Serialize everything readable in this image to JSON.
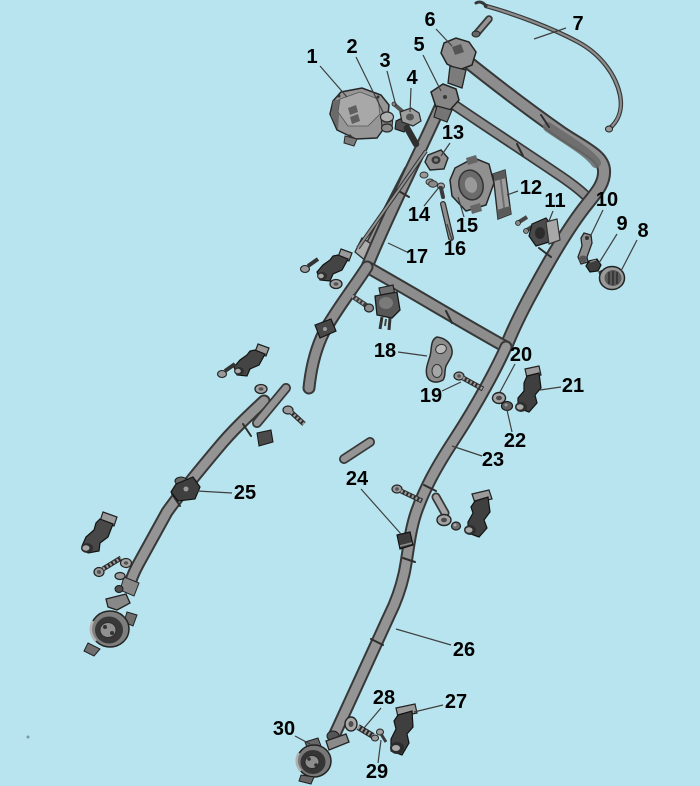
{
  "diagram": {
    "background": "#b7e4ee",
    "label_color": "#000000",
    "leader_color": "#3f3f3f",
    "part_fill": "#8d8d8d",
    "part_outline": "#333333"
  },
  "callouts": [
    {
      "label": "1",
      "x": 312,
      "y": 57,
      "leader": {
        "x1": 320,
        "y1": 66,
        "x2": 347,
        "y2": 97
      }
    },
    {
      "label": "2",
      "x": 352,
      "y": 47,
      "leader": {
        "x1": 356,
        "y1": 57,
        "x2": 384,
        "y2": 114
      }
    },
    {
      "label": "3",
      "x": 385,
      "y": 61,
      "leader": {
        "x1": 387,
        "y1": 71,
        "x2": 396,
        "y2": 106
      }
    },
    {
      "label": "4",
      "x": 412,
      "y": 78,
      "leader": {
        "x1": 411,
        "y1": 88,
        "x2": 410,
        "y2": 112
      }
    },
    {
      "label": "5",
      "x": 419,
      "y": 45,
      "leader": {
        "x1": 423,
        "y1": 55,
        "x2": 441,
        "y2": 91
      }
    },
    {
      "label": "6",
      "x": 430,
      "y": 20,
      "leader": {
        "x1": 436,
        "y1": 29,
        "x2": 452,
        "y2": 46
      }
    },
    {
      "label": "7",
      "x": 578,
      "y": 24,
      "leader": {
        "x1": 566,
        "y1": 28,
        "x2": 534,
        "y2": 39
      }
    },
    {
      "label": "8",
      "x": 643,
      "y": 231,
      "leader": {
        "x1": 637,
        "y1": 240,
        "x2": 621,
        "y2": 271
      }
    },
    {
      "label": "9",
      "x": 622,
      "y": 224,
      "leader": {
        "x1": 617,
        "y1": 234,
        "x2": 599,
        "y2": 263
      }
    },
    {
      "label": "10",
      "x": 607,
      "y": 200,
      "leader": {
        "x1": 603,
        "y1": 210,
        "x2": 590,
        "y2": 237
      }
    },
    {
      "label": "11",
      "x": 555,
      "y": 201,
      "leader": {
        "x1": 553,
        "y1": 211,
        "x2": 549,
        "y2": 221
      }
    },
    {
      "label": "12",
      "x": 531,
      "y": 188,
      "leader": {
        "x1": 518,
        "y1": 191,
        "x2": 507,
        "y2": 195
      }
    },
    {
      "label": "13",
      "x": 453,
      "y": 133,
      "leader": {
        "x1": 450,
        "y1": 143,
        "x2": 441,
        "y2": 156
      }
    },
    {
      "label": "14",
      "x": 419,
      "y": 215,
      "leader": {
        "x1": 424,
        "y1": 206,
        "x2": 440,
        "y2": 186
      }
    },
    {
      "label": "15",
      "x": 467,
      "y": 226,
      "leader": {
        "x1": 464,
        "y1": 217,
        "x2": 458,
        "y2": 197
      }
    },
    {
      "label": "16",
      "x": 455,
      "y": 249,
      "leader": {
        "x1": 452,
        "y1": 240,
        "x2": 447,
        "y2": 224
      }
    },
    {
      "label": "17",
      "x": 417,
      "y": 257,
      "leader": {
        "x1": 407,
        "y1": 252,
        "x2": 388,
        "y2": 243
      }
    },
    {
      "label": "18",
      "x": 385,
      "y": 351,
      "leader": {
        "x1": 398,
        "y1": 352,
        "x2": 427,
        "y2": 356
      }
    },
    {
      "label": "19",
      "x": 431,
      "y": 396,
      "leader": {
        "x1": 442,
        "y1": 391,
        "x2": 461,
        "y2": 382
      }
    },
    {
      "label": "20",
      "x": 521,
      "y": 355,
      "leader": {
        "x1": 515,
        "y1": 364,
        "x2": 500,
        "y2": 392
      }
    },
    {
      "label": "21",
      "x": 573,
      "y": 386,
      "leader": {
        "x1": 561,
        "y1": 387,
        "x2": 540,
        "y2": 390
      }
    },
    {
      "label": "22",
      "x": 515,
      "y": 441,
      "leader": {
        "x1": 512,
        "y1": 432,
        "x2": 507,
        "y2": 410
      }
    },
    {
      "label": "23",
      "x": 493,
      "y": 460,
      "leader": {
        "x1": 482,
        "y1": 456,
        "x2": 452,
        "y2": 446
      }
    },
    {
      "label": "24",
      "x": 357,
      "y": 479,
      "leader": {
        "x1": 361,
        "y1": 489,
        "x2": 401,
        "y2": 534
      }
    },
    {
      "label": "25",
      "x": 245,
      "y": 493,
      "leader": {
        "x1": 232,
        "y1": 493,
        "x2": 197,
        "y2": 491
      }
    },
    {
      "label": "26",
      "x": 464,
      "y": 650,
      "leader": {
        "x1": 451,
        "y1": 645,
        "x2": 396,
        "y2": 629
      }
    },
    {
      "label": "27",
      "x": 456,
      "y": 702,
      "leader": {
        "x1": 443,
        "y1": 705,
        "x2": 414,
        "y2": 712
      }
    },
    {
      "label": "28",
      "x": 384,
      "y": 698,
      "leader": {
        "x1": 381,
        "y1": 708,
        "x2": 364,
        "y2": 728
      }
    },
    {
      "label": "29",
      "x": 377,
      "y": 772,
      "leader": {
        "x1": 378,
        "y1": 763,
        "x2": 381,
        "y2": 740
      }
    },
    {
      "label": "30",
      "x": 284,
      "y": 729,
      "leader": {
        "x1": 295,
        "y1": 736,
        "x2": 310,
        "y2": 744
      }
    }
  ]
}
